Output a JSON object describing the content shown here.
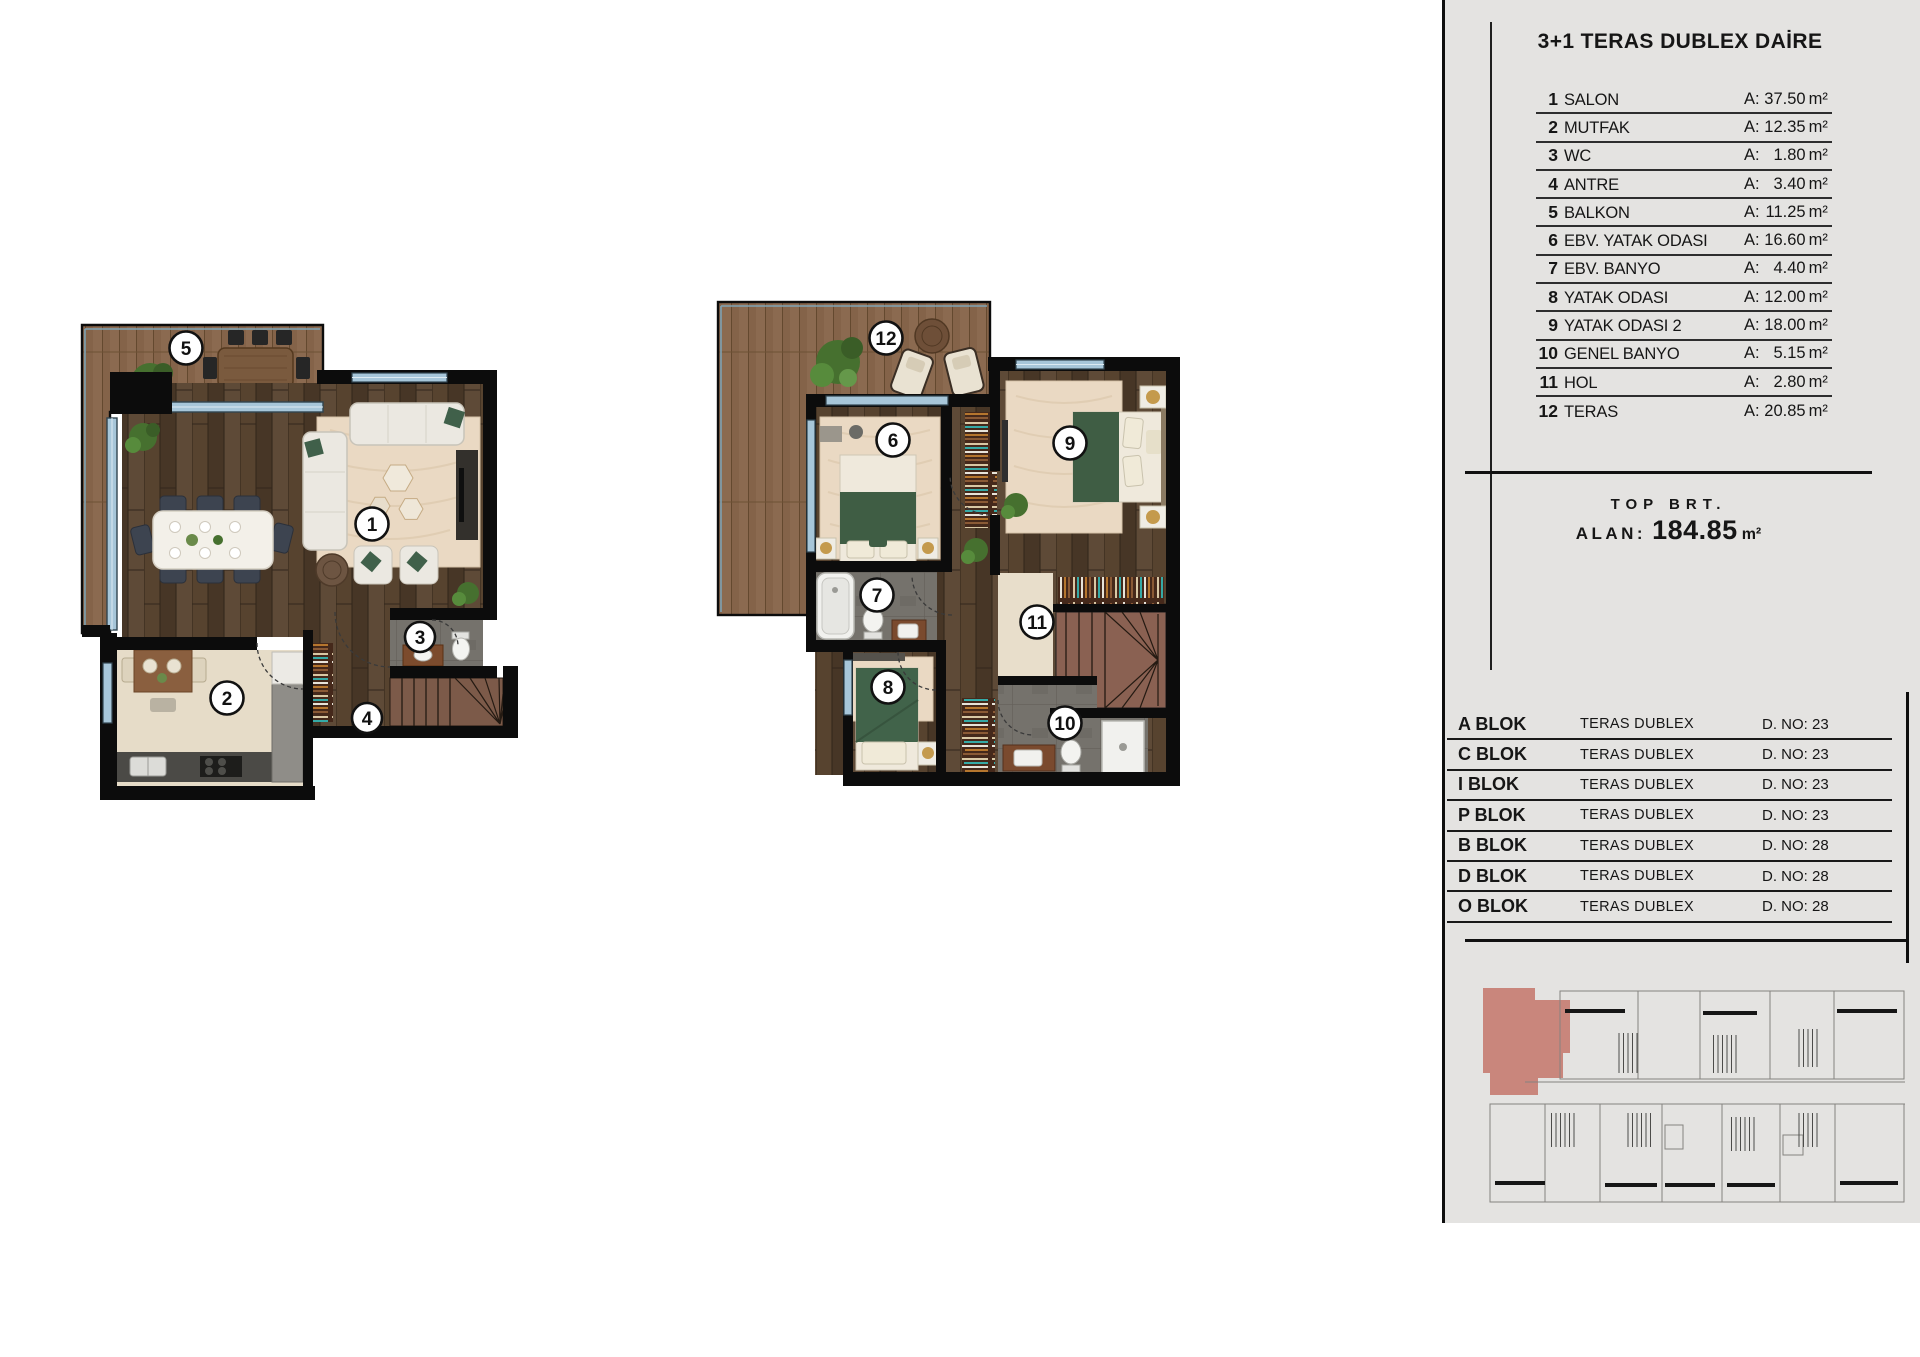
{
  "colors": {
    "panel_bg": "#e4e3e1",
    "line": "#111111",
    "highlight_unit": "#c9867c",
    "deck_wood": "#8b6a50",
    "floor_wood": "#4e3c2c",
    "rug": "#ead9c3",
    "accent_green": "#3f5d44",
    "glass": "#a7c6d9",
    "tile_gray": "#75726c",
    "stair_brown": "#8a6152"
  },
  "panel": {
    "title": "3+1 TERAS DUBLEX DAİRE",
    "rooms": [
      {
        "num": "1",
        "name": "SALON",
        "area_label": "A:",
        "area": "37.50",
        "unit": "m²"
      },
      {
        "num": "2",
        "name": "MUTFAK",
        "area_label": "A:",
        "area": "12.35",
        "unit": "m²"
      },
      {
        "num": "3",
        "name": "WC",
        "area_label": "A:",
        "area": "1.80",
        "unit": "m²"
      },
      {
        "num": "4",
        "name": "ANTRE",
        "area_label": "A:",
        "area": "3.40",
        "unit": "m²"
      },
      {
        "num": "5",
        "name": "BALKON",
        "area_label": "A:",
        "area": "11.25",
        "unit": "m²"
      },
      {
        "num": "6",
        "name": "EBV. YATAK ODASI",
        "area_label": "A:",
        "area": "16.60",
        "unit": "m²"
      },
      {
        "num": "7",
        "name": "EBV. BANYO",
        "area_label": "A:",
        "area": "4.40",
        "unit": "m²"
      },
      {
        "num": "8",
        "name": "YATAK ODASI",
        "area_label": "A:",
        "area": "12.00",
        "unit": "m²"
      },
      {
        "num": "9",
        "name": "YATAK ODASI 2",
        "area_label": "A:",
        "area": "18.00",
        "unit": "m²"
      },
      {
        "num": "10",
        "name": "GENEL BANYO",
        "area_label": "A:",
        "area": "5.15",
        "unit": "m²"
      },
      {
        "num": "11",
        "name": "HOL",
        "area_label": "A:",
        "area": "2.80",
        "unit": "m²"
      },
      {
        "num": "12",
        "name": "TERAS",
        "area_label": "A:",
        "area": "20.85",
        "unit": "m²"
      }
    ],
    "summary": {
      "brt": "TOP BRT.",
      "alan_label": "ALAN:",
      "alan_value": "184.85",
      "alan_unit": "m²"
    },
    "blocks": [
      {
        "block": "A BLOK",
        "type": "TERAS DUBLEX",
        "no": "D. NO: 23"
      },
      {
        "block": "C BLOK",
        "type": "TERAS DUBLEX",
        "no": "D. NO: 23"
      },
      {
        "block": "I BLOK",
        "type": "TERAS DUBLEX",
        "no": "D. NO: 23"
      },
      {
        "block": "P BLOK",
        "type": "TERAS DUBLEX",
        "no": "D. NO: 23"
      },
      {
        "block": "B BLOK",
        "type": "TERAS DUBLEX",
        "no": "D. NO: 28"
      },
      {
        "block": "D BLOK",
        "type": "TERAS DUBLEX",
        "no": "D. NO: 28"
      },
      {
        "block": "O BLOK",
        "type": "TERAS DUBLEX",
        "no": "D. NO: 28"
      }
    ]
  },
  "plan1": {
    "labels": [
      "1",
      "2",
      "3",
      "4",
      "5"
    ]
  },
  "plan2": {
    "labels": [
      "6",
      "7",
      "8",
      "9",
      "10",
      "11",
      "12"
    ]
  }
}
